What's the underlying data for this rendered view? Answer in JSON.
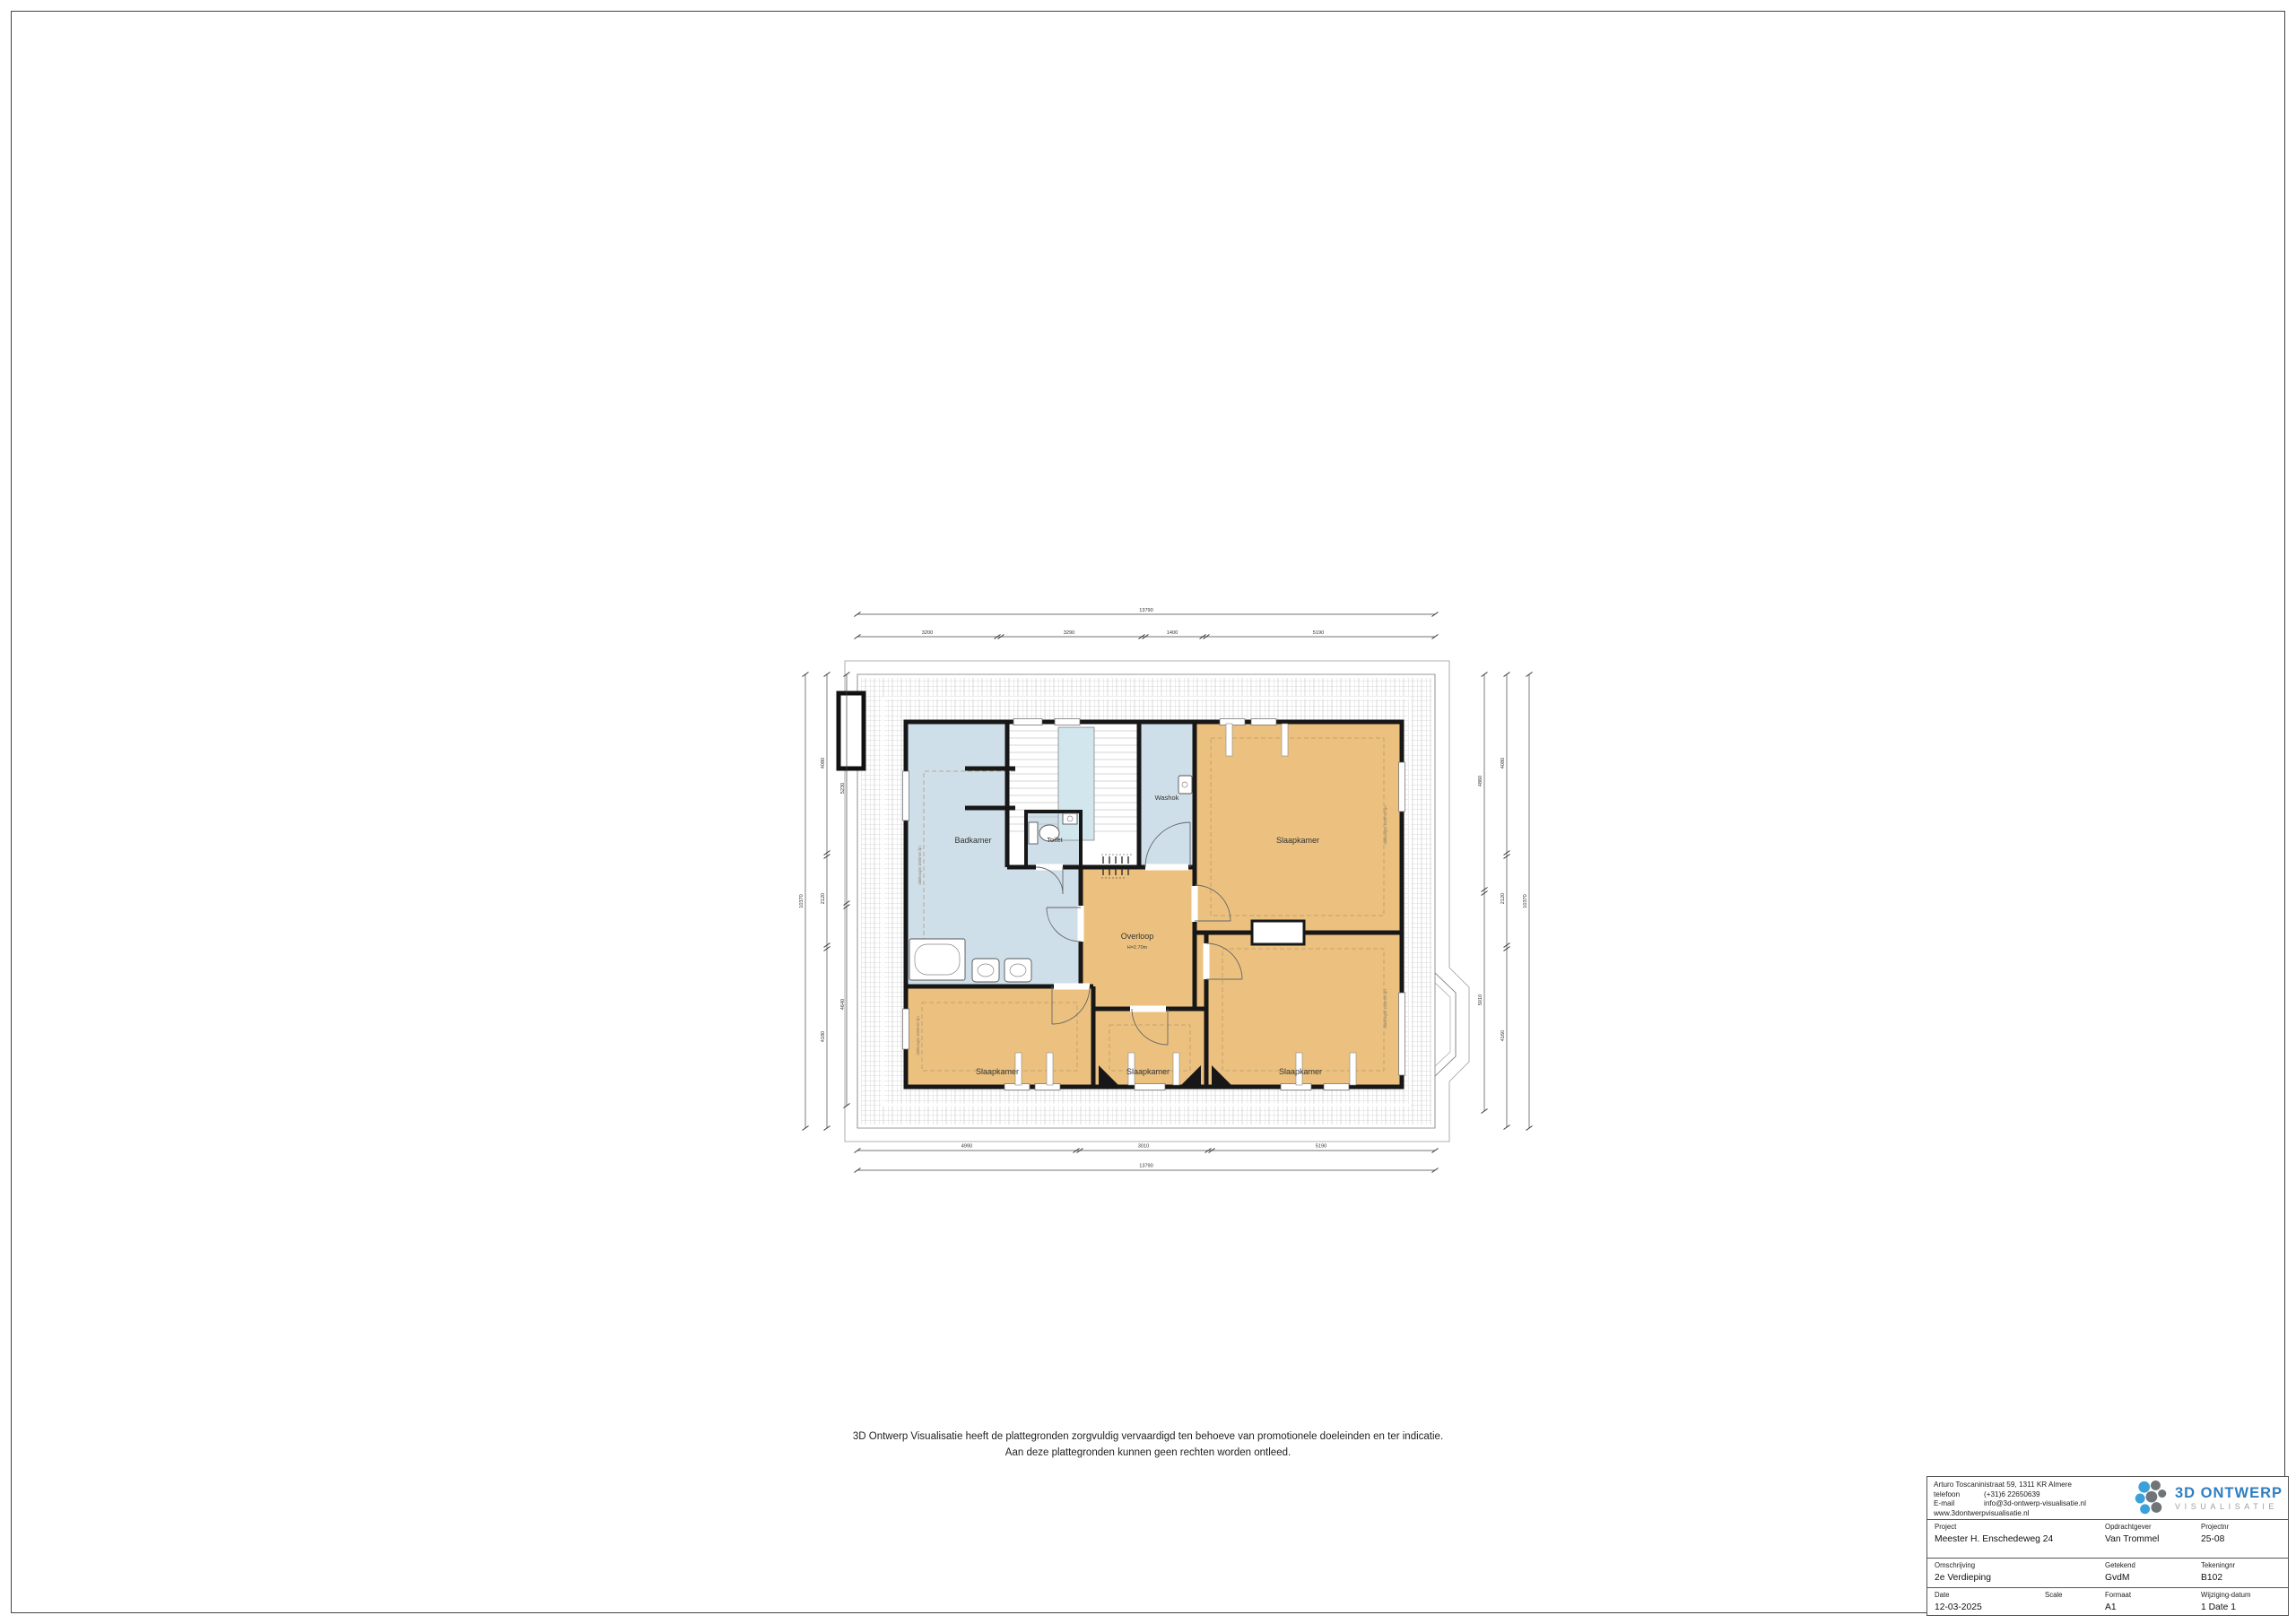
{
  "sheet": {
    "disclaimer_line1": "3D Ontwerp Visualisatie heeft de plattegronden zorgvuldig vervaardigd ten behoeve van promotionele doeleinden en ter indicatie.",
    "disclaimer_line2": "Aan deze plattegronden kunnen geen rechten worden ontleed."
  },
  "plan": {
    "rooms": {
      "badkamer": "Badkamer",
      "toilet": "Toilet",
      "washok": "Washok",
      "slaapkamer": "Slaapkamer",
      "overloop": "Overloop",
      "overloop_height": "H=2.70m"
    },
    "annotations": {
      "knee_line": "dakhoogte 1500mm lijn"
    },
    "dimensions": {
      "top_total": "13790",
      "top_segments": [
        "3200",
        "3290",
        "1400",
        "5190"
      ],
      "bottom_segments": [
        "4990",
        "3010",
        "5190"
      ],
      "bottom_total": "13790",
      "left_outer_total": "10370",
      "left_mid_segments": [
        "4080",
        "2120",
        "4180"
      ],
      "left_inner_segments": [
        "5230",
        "4640"
      ],
      "right_inner_segments": [
        "4860",
        "5010"
      ],
      "right_mid_segments": [
        "4080",
        "2120",
        "4160"
      ],
      "right_outer_total": "10370"
    },
    "colors": {
      "room_orange": "#ecc17f",
      "room_blue": "#cfdfe9",
      "wall": "#171717"
    }
  },
  "title_block": {
    "address": {
      "line1": "Arturo Toscaninistraat 59, 1311 KR Almere",
      "phone_label": "telefoon",
      "phone_value": "(+31)6 22650639",
      "email_label": "E-mail",
      "email_value": "info@3d-ontwerp-visualisatie.nl",
      "website": "www.3dontwerpvisualisatie.nl"
    },
    "logo": {
      "line1": "3D ONTWERP",
      "line2": "VISUALISATIE"
    },
    "fields": {
      "project_label": "Project",
      "project_value": "Meester H. Enschedeweg 24",
      "opdrachtgever_label": "Opdrachtgever",
      "opdrachtgever_value": "Van Trommel",
      "projectnr_label": "Projectnr",
      "projectnr_value": "25-08",
      "omschrijving_label": "Omschrijving",
      "omschrijving_value": "2e Verdieping",
      "getekend_label": "Getekend",
      "getekend_value": "GvdM",
      "tekeningnr_label": "Tekeningnr",
      "tekeningnr_value": "B102",
      "date_label": "Date",
      "date_value": "12-03-2025",
      "scale_label": "Scale",
      "scale_value": "",
      "formaat_label": "Formaat",
      "formaat_value": "A1",
      "wijziging_label": "Wijziging-datum",
      "wijziging_value": "1  Date 1"
    }
  }
}
